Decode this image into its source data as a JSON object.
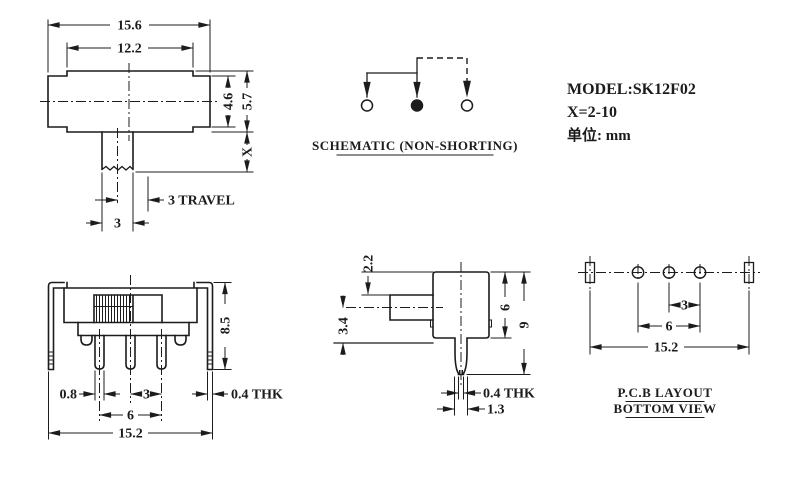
{
  "info": {
    "model": "MODEL:SK12F02",
    "x_range": "X=2-10",
    "unit": "单位: mm"
  },
  "top_view": {
    "dims": {
      "overall_width": "15.6",
      "inner_width": "12.2",
      "side_height": "4.6",
      "center_height": "5.7",
      "stem_height": "X",
      "travel": "3 TRAVEL",
      "stem_width": "3"
    }
  },
  "schematic": {
    "title": "SCHEMATIC (NON-SHORTING)"
  },
  "front_view": {
    "dims": {
      "height": "8.5",
      "pin_width": "0.8",
      "pin_pitch": "3",
      "pin_span": "6",
      "overall_width": "15.2",
      "bracket_thickness": "0.4 THK"
    }
  },
  "side_view": {
    "dims": {
      "top_clearance": "2.2",
      "stem_center_height": "3.4",
      "body_height": "6",
      "overall_height": "9",
      "pin_thickness": "0.4 THK",
      "pin_root_width": "1.3"
    }
  },
  "pcb_view": {
    "title_line1": "P.C.B LAYOUT",
    "title_line2": "BOTTOM VIEW",
    "dims": {
      "hole_pitch": "3",
      "hole_span": "6",
      "slot_span": "15.2"
    }
  },
  "colors": {
    "line": "#1c1c1c",
    "background": "#ffffff"
  }
}
